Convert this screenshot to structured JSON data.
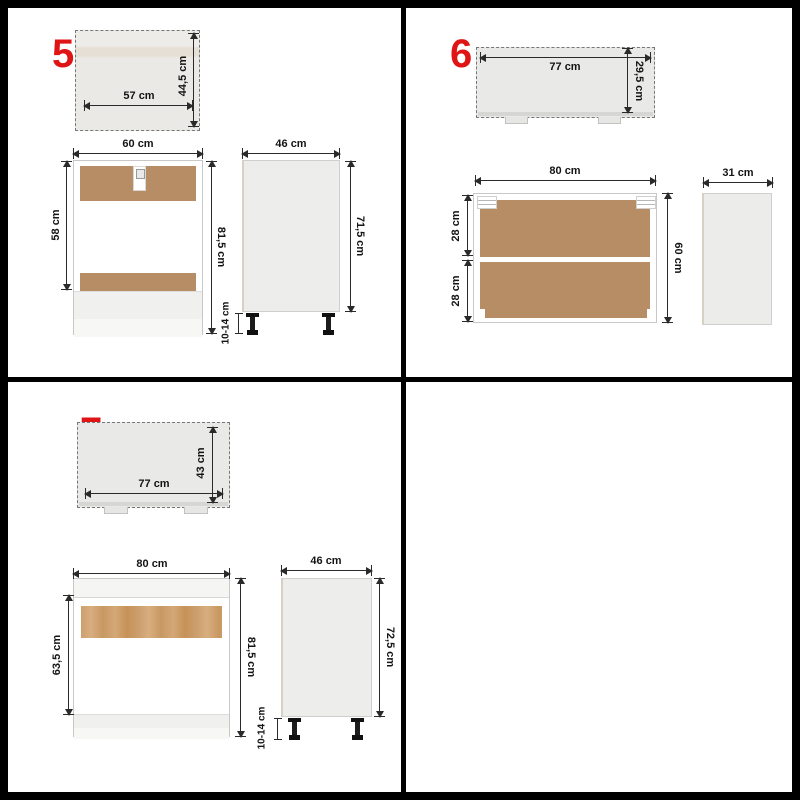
{
  "title": "Kitchen cabinet set dimension diagrams",
  "accent_color": "#df1414",
  "line_color": "#2a2a2a",
  "wood_color": "#b68d64",
  "panels": {
    "p5": {
      "number": "5",
      "top_view": {
        "width": "57 cm",
        "depth": "44,5 cm"
      },
      "front_view": {
        "width": "60 cm",
        "carcass_height": "58 cm",
        "total_height": "81,5 cm"
      },
      "side_view": {
        "depth": "46 cm",
        "height": "71,5 cm",
        "leg_height": "10-14 cm"
      }
    },
    "p6": {
      "number": "6",
      "top_view": {
        "width": "77 cm",
        "depth": "29,5 cm"
      },
      "front_view": {
        "width": "80 cm",
        "upper_compartment": "28 cm",
        "lower_compartment": "28 cm",
        "height": "60 cm"
      },
      "side_view": {
        "depth": "31 cm"
      }
    },
    "p7": {
      "number": "7",
      "top_view": {
        "width": "77 cm",
        "depth": "43 cm"
      },
      "front_view": {
        "width": "80 cm",
        "carcass_height": "63,5 cm",
        "total_height": "81,5 cm"
      },
      "side_view": {
        "depth": "46 cm",
        "height": "72,5 cm",
        "leg_height": "10-14 cm"
      }
    }
  }
}
